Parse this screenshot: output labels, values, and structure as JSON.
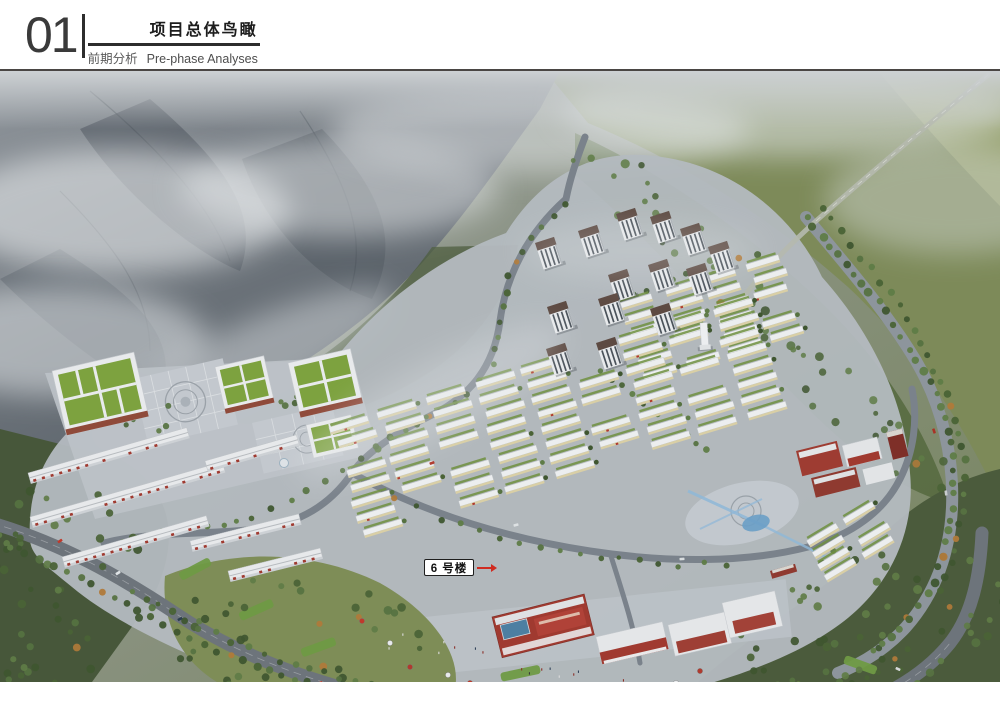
{
  "header": {
    "section_number": "01",
    "title": "项目总体鸟瞰",
    "subtitle_cn": "前期分析",
    "subtitle_en": "Pre-phase Analyses"
  },
  "rendering": {
    "annotation_label": "6 号楼"
  },
  "palette": {
    "header_text": "#2d2d2d",
    "arrow_red": "#d02b20",
    "accent_red": "#a03a30",
    "glass_blue": "#4d7fa2",
    "wall_cream": "#d9cfa6",
    "hedge_green": "#6f8f3f",
    "lawn_green": "#6f9a44",
    "field_green": "#7d8a59",
    "forest_green": "#4b5b3c",
    "mountain_gray": "#565e66",
    "mist_gray": "#dfe3e6",
    "road_gray": "#6d747b",
    "pavement_gray": "#b4bac0",
    "roof_white": "#e8eaec"
  }
}
